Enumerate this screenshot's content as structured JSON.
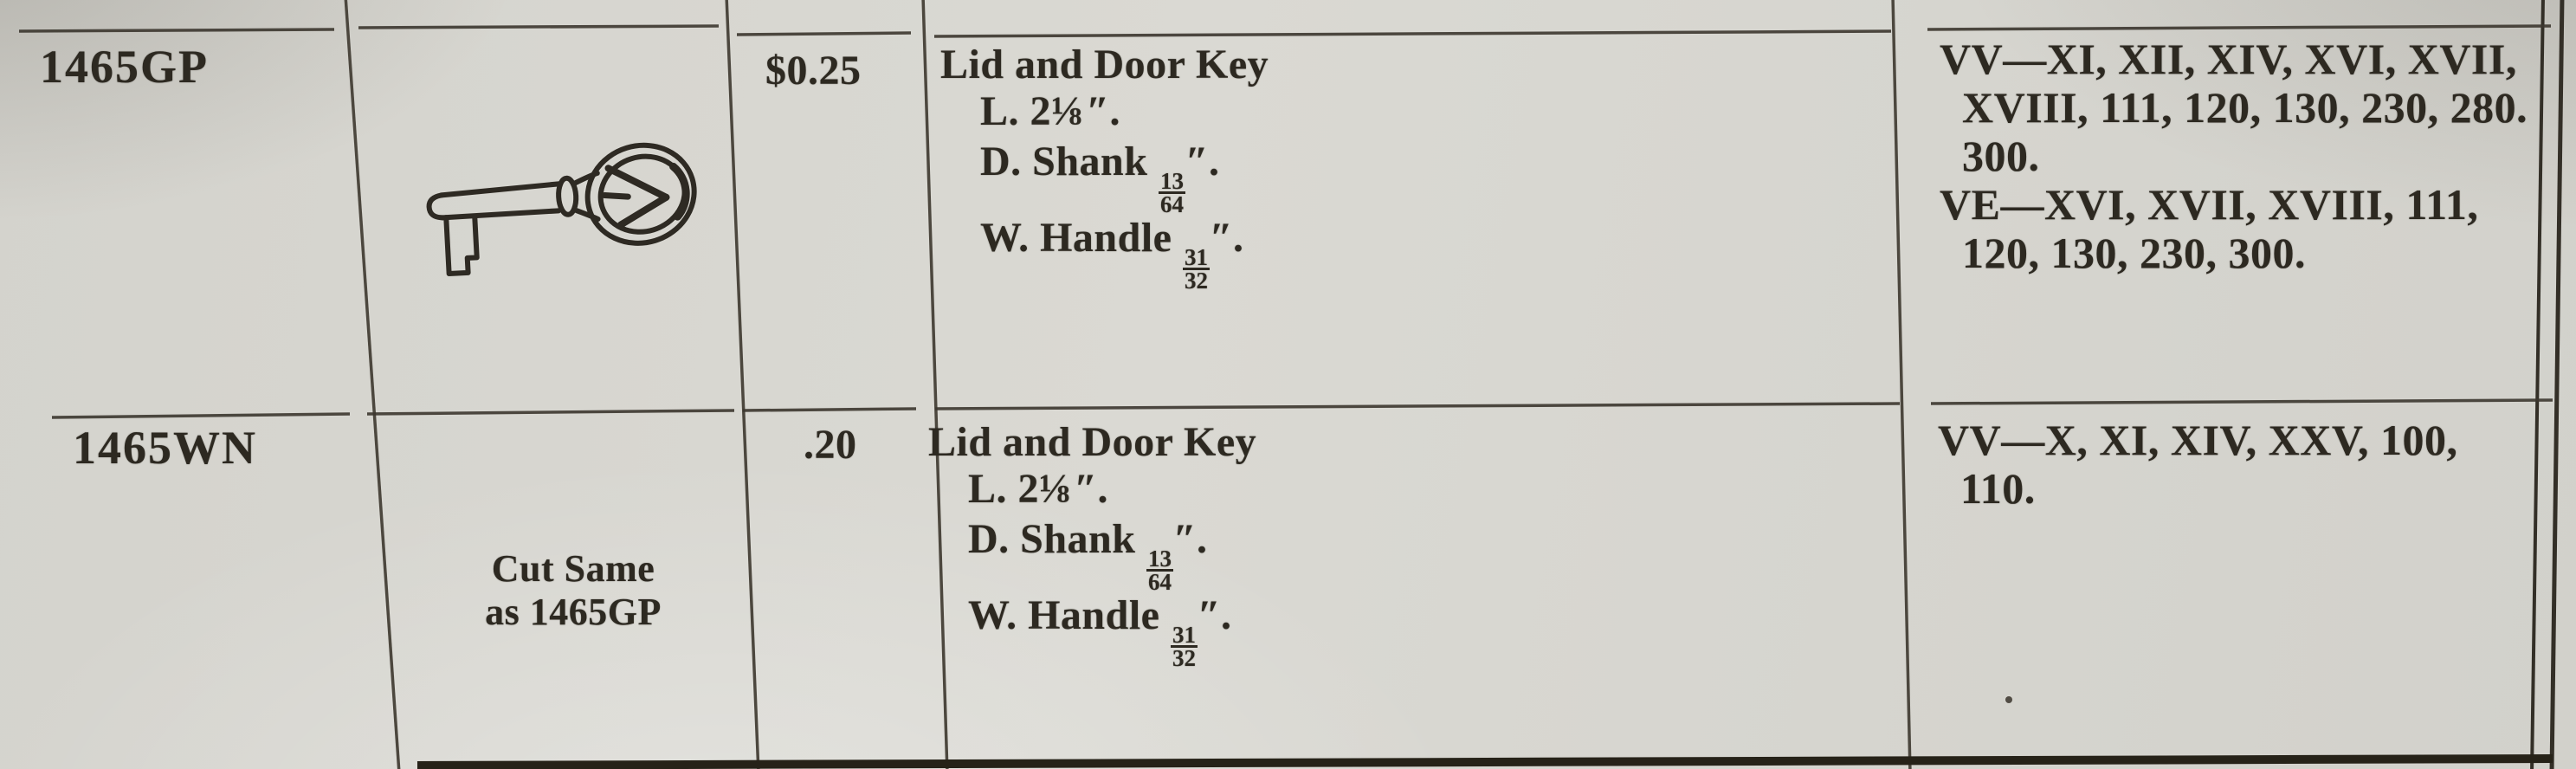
{
  "colors": {
    "paper": "#d7d6d0",
    "ink": "#2d2921",
    "rule": "#3c372f"
  },
  "rows": [
    {
      "part_number": "1465GP",
      "illustration": "skeleton-key",
      "price": "$0.25",
      "description": {
        "title": "Lid and Door Key",
        "lines": [
          {
            "pre": "L. 2⅛",
            "post": "″."
          },
          {
            "pre": "D. Shank ",
            "num": "13",
            "den": "64",
            "post": "″."
          },
          {
            "pre": "W. Handle ",
            "num": "31",
            "den": "32",
            "post": "″."
          }
        ]
      },
      "models": [
        "VV—XI, XII, XIV, XVI, XVII,",
        "XVIII, 111, 120, 130, 230, 280.",
        "300.",
        "VE—XVI, XVII, XVIII, 111,",
        "120, 130, 230, 300."
      ]
    },
    {
      "part_number": "1465WN",
      "illustration_note": [
        "Cut Same",
        "as 1465GP"
      ],
      "price": ".20",
      "description": {
        "title": "Lid and Door Key",
        "lines": [
          {
            "pre": "L. 2⅛",
            "post": "″."
          },
          {
            "pre": "D. Shank ",
            "num": "13",
            "den": "64",
            "post": "″."
          },
          {
            "pre": "W. Handle ",
            "num": "31",
            "den": "32",
            "post": "″."
          }
        ]
      },
      "models": [
        "VV—X, XI, XIV, XXV, 100,",
        "110."
      ]
    }
  ]
}
